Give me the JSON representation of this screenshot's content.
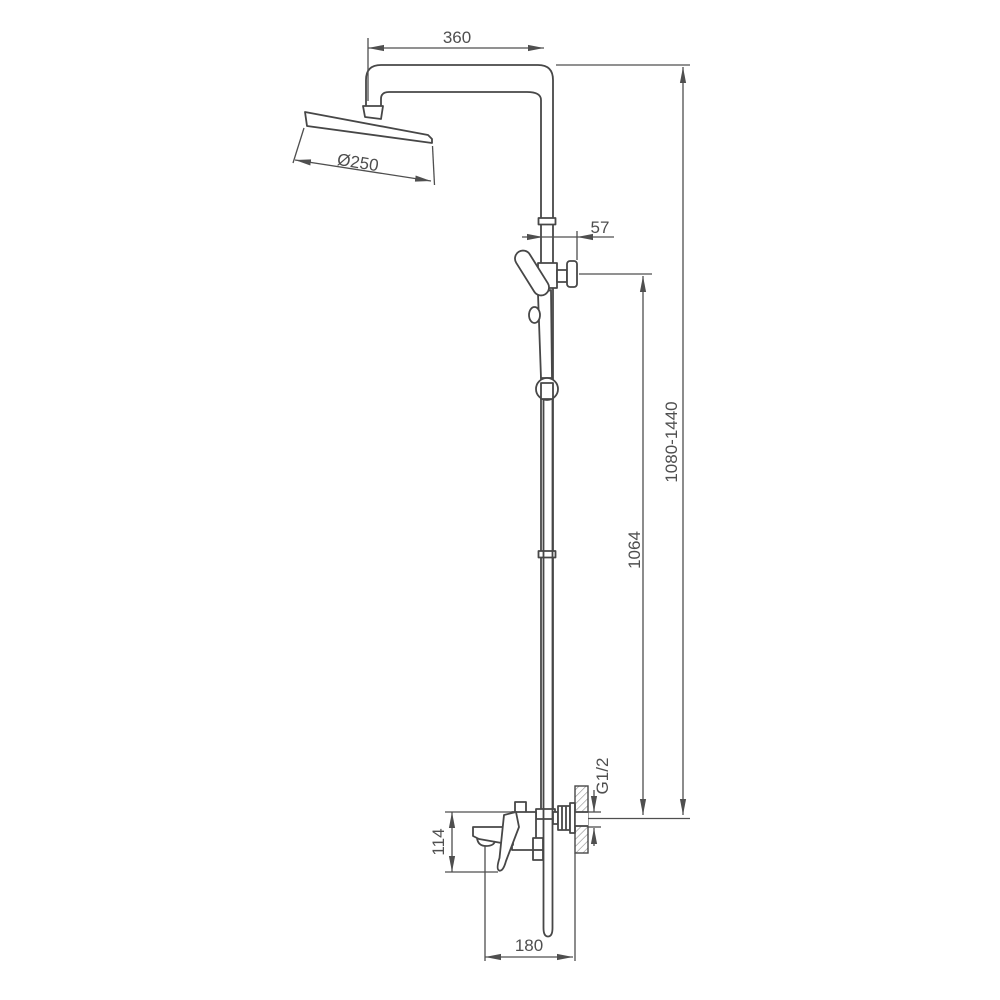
{
  "drawing": {
    "kind": "shower-system-dimension-drawing",
    "colors": {
      "background": "#ffffff",
      "line": "#474747",
      "dimension": "#4f4f4f",
      "hatch": "#8a8a8a"
    },
    "dimensions": {
      "arm_reach": "360",
      "head_diameter": "Ø250",
      "bracket_offset": "57",
      "overall_height_range": "1080-1440",
      "riser_height": "1064",
      "wall_thread": "G1/2",
      "spout_drop": "114",
      "wall_offset": "180"
    }
  }
}
